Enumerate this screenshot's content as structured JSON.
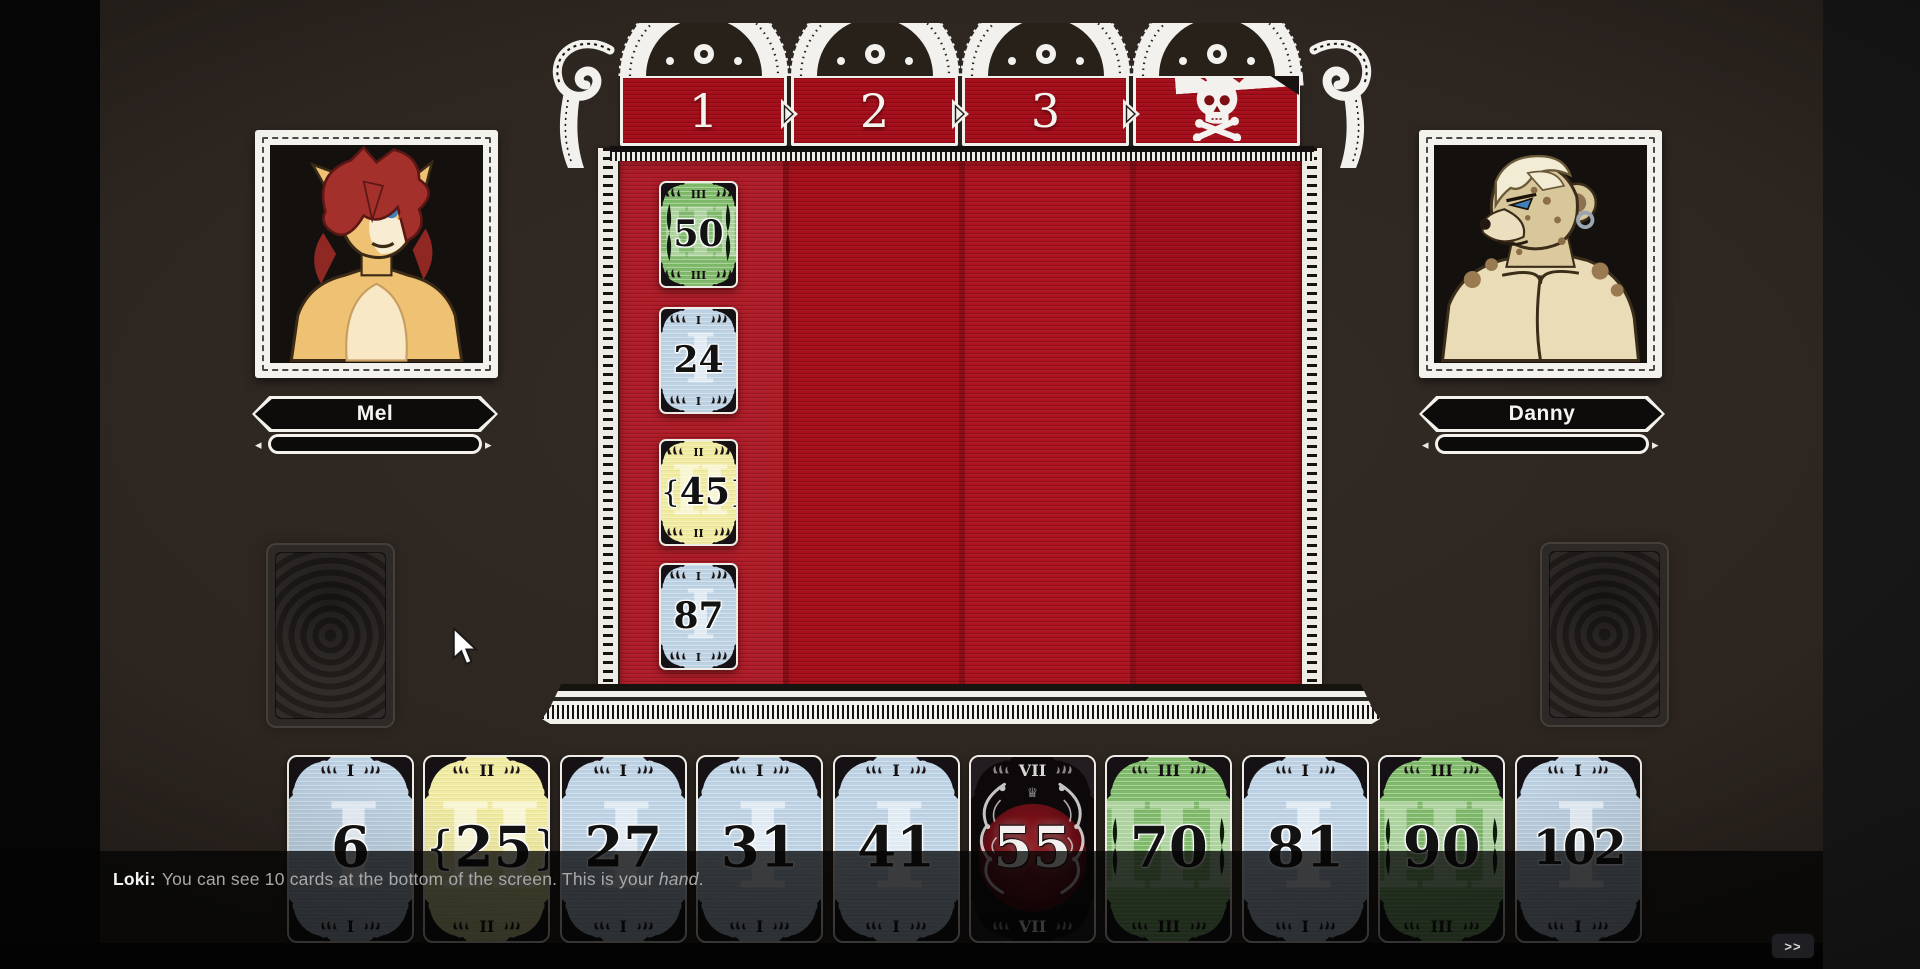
{
  "players": {
    "left": {
      "name": "Mel",
      "avatar": "mel-cat-portrait"
    },
    "right": {
      "name": "Danny",
      "avatar": "danny-hyena-portrait"
    }
  },
  "board": {
    "column_headers": [
      "1",
      "2",
      "3",
      "skull-crossbones"
    ],
    "placed_cards": [
      {
        "column": 1,
        "row": 1,
        "value": "50",
        "tier": "III",
        "color": "green"
      },
      {
        "column": 1,
        "row": 2,
        "value": "24",
        "tier": "I",
        "color": "blue"
      },
      {
        "column": 1,
        "row": 3,
        "value": "45",
        "tier": "II",
        "color": "yellow"
      },
      {
        "column": 1,
        "row": 4,
        "value": "87",
        "tier": "I",
        "color": "blue"
      }
    ]
  },
  "hand": {
    "cards": [
      {
        "value": "6",
        "tier": "I",
        "color": "blue"
      },
      {
        "value": "25",
        "tier": "II",
        "color": "yellow"
      },
      {
        "value": "27",
        "tier": "I",
        "color": "blue"
      },
      {
        "value": "31",
        "tier": "I",
        "color": "blue"
      },
      {
        "value": "41",
        "tier": "I",
        "color": "blue"
      },
      {
        "value": "55",
        "tier": "VII",
        "color": "black"
      },
      {
        "value": "70",
        "tier": "III",
        "color": "green"
      },
      {
        "value": "81",
        "tier": "I",
        "color": "blue"
      },
      {
        "value": "90",
        "tier": "III",
        "color": "green"
      },
      {
        "value": "102",
        "tier": "I",
        "color": "blue"
      }
    ]
  },
  "tutorial": {
    "speaker": "Loki:",
    "text_before": "You can see 10 cards at the bottom of the screen. This is your ",
    "emphasis": "hand",
    "text_after": "."
  },
  "controls": {
    "skip_label": ">>"
  },
  "colors": {
    "background": "#2b241f",
    "board_red": "#ab0f1b",
    "frame_white": "#f2f0ea",
    "card_blue": "#bdd2e4",
    "card_yellow": "#f1eb9f",
    "card_green": "#7fba6a",
    "card_black": "#0d090b"
  }
}
